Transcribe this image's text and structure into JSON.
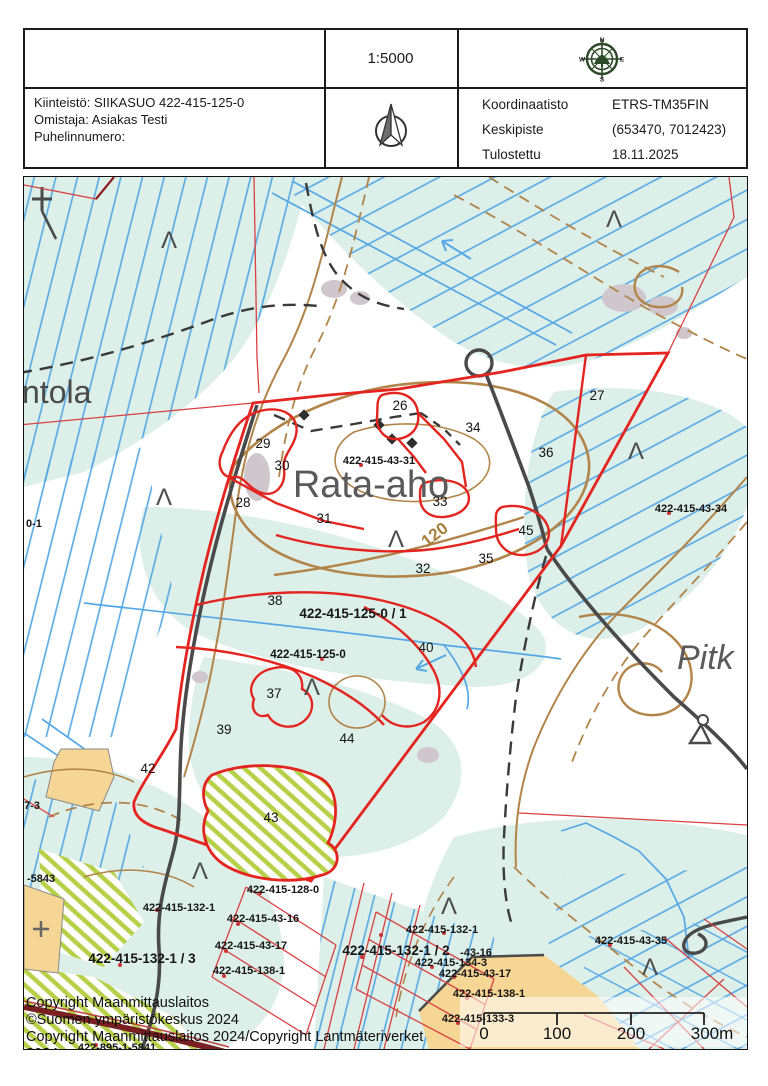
{
  "header": {
    "scale": "1:5000",
    "property": {
      "line1": "Kiinteistö: SIIKASUO 422-415-125-0",
      "line2": "Omistaja: Asiakas Testi",
      "line3": "Puhelinnumero:"
    },
    "meta": [
      {
        "key": "Koordinaatisto",
        "value": "ETRS-TM35FIN"
      },
      {
        "key": "Keskipiste",
        "value": "(653470, 7012423)"
      },
      {
        "key": "Tulostettu",
        "value": "18.11.2025"
      }
    ],
    "compass": {
      "n": "N",
      "e": "E",
      "s": "S",
      "w": "W"
    }
  },
  "map": {
    "place_names": [
      {
        "t": "ntola",
        "x": -2,
        "y": 226,
        "s": 32,
        "a": "start",
        "fill": "#4a4a4a",
        "italic": false
      },
      {
        "t": "Rata-aho",
        "x": 347,
        "y": 320,
        "s": 38,
        "a": "middle",
        "fill": "#5a5a5a",
        "italic": false
      },
      {
        "t": "Pitk",
        "x": 653,
        "y": 492,
        "s": 34,
        "a": "start",
        "fill": "#5a5a5a",
        "italic": true
      }
    ],
    "contour_label": {
      "t": "120",
      "x": 414,
      "y": 362,
      "s": 17,
      "fill": "#a5803a",
      "rot": -38
    },
    "stand_numbers": [
      {
        "t": "26",
        "x": 376,
        "y": 233
      },
      {
        "t": "27",
        "x": 573,
        "y": 223
      },
      {
        "t": "29",
        "x": 239,
        "y": 271
      },
      {
        "t": "30",
        "x": 258,
        "y": 293
      },
      {
        "t": "28",
        "x": 219,
        "y": 330
      },
      {
        "t": "31",
        "x": 300,
        "y": 346
      },
      {
        "t": "34",
        "x": 449,
        "y": 255
      },
      {
        "t": "36",
        "x": 522,
        "y": 280
      },
      {
        "t": "33",
        "x": 416,
        "y": 329
      },
      {
        "t": "45",
        "x": 502,
        "y": 358
      },
      {
        "t": "35",
        "x": 462,
        "y": 386
      },
      {
        "t": "32",
        "x": 399,
        "y": 396
      },
      {
        "t": "38",
        "x": 251,
        "y": 428
      },
      {
        "t": "40",
        "x": 402,
        "y": 475
      },
      {
        "t": "37",
        "x": 250,
        "y": 521
      },
      {
        "t": "39",
        "x": 200,
        "y": 557
      },
      {
        "t": "44",
        "x": 323,
        "y": 566
      },
      {
        "t": "42",
        "x": 124,
        "y": 596
      },
      {
        "t": "43",
        "x": 247,
        "y": 645
      }
    ],
    "parcel_ids": [
      {
        "t": "422-415-43-31",
        "x": 355,
        "y": 287,
        "s": 11
      },
      {
        "t": "422-415-43-34",
        "x": 667,
        "y": 335,
        "s": 11
      },
      {
        "t": "422-415-125-0 / 1",
        "x": 329,
        "y": 441,
        "s": 13.5
      },
      {
        "t": "422-415-125-0",
        "x": 284,
        "y": 481,
        "s": 11.5
      },
      {
        "t": "422-415-128-0",
        "x": 259,
        "y": 716,
        "s": 11
      },
      {
        "t": "422-415-132-1",
        "x": 155,
        "y": 734,
        "s": 11
      },
      {
        "t": "422-415-43-16",
        "x": 239,
        "y": 745,
        "s": 11
      },
      {
        "t": "422-415-43-17",
        "x": 227,
        "y": 772,
        "s": 11
      },
      {
        "t": "422-415-138-1",
        "x": 225,
        "y": 797,
        "s": 11
      },
      {
        "t": "422-415-132-1 / 3",
        "x": 118,
        "y": 786,
        "s": 13.5
      },
      {
        "t": "422-895-1-5841",
        "x": 93,
        "y": 874,
        "s": 11
      },
      {
        "t": "-5843",
        "x": 3,
        "y": 705,
        "s": 11,
        "a": "start"
      },
      {
        "t": "0-1",
        "x": 2,
        "y": 350,
        "s": 11,
        "a": "start"
      },
      {
        "t": "27-3",
        "x": -6,
        "y": 632,
        "s": 11,
        "a": "start"
      },
      {
        "t": "422-415-132-1",
        "x": 418,
        "y": 756,
        "s": 11
      },
      {
        "t": "422-415-132-1 / 2",
        "x": 372,
        "y": 778,
        "s": 13.5
      },
      {
        "t": "-43-16",
        "x": 452,
        "y": 779,
        "s": 11
      },
      {
        "t": "422-415-134-3",
        "x": 427,
        "y": 789,
        "s": 11
      },
      {
        "t": "422-415-43-17",
        "x": 451,
        "y": 800,
        "s": 11
      },
      {
        "t": "422-415-138-1",
        "x": 465,
        "y": 820,
        "s": 11
      },
      {
        "t": "422-415-133-3",
        "x": 454,
        "y": 845,
        "s": 11
      },
      {
        "t": "422-415-43-35",
        "x": 607,
        "y": 767,
        "s": 11
      },
      {
        "t": "422-415-43-60",
        "x": 477,
        "y": 880,
        "s": 11
      }
    ],
    "swamp": {
      "glyph": "Λ",
      "positions": [
        [
          145,
          71
        ],
        [
          590,
          50
        ],
        [
          612,
          282
        ],
        [
          372,
          370
        ],
        [
          288,
          518
        ],
        [
          176,
          702
        ],
        [
          425,
          737
        ],
        [
          626,
          798
        ],
        [
          140,
          328
        ]
      ]
    },
    "copyright_lines": [
      "Copyright Maanmittauslaitos",
      "©Suomen ympäristökeskus 2024",
      "Copyright Maanmittauslaitos 2024/Copyright Lantmäteriverket",
      "2024"
    ],
    "scale_bar": {
      "labels": [
        "0",
        "100",
        "200",
        "300m"
      ]
    }
  },
  "colors": {
    "boundary_red": "#e3241f",
    "cadastral_red": "#d94040",
    "wetland_cyan": "#dcefe9",
    "ditch_blue": "#55a8e5",
    "contour_brown": "#b28449",
    "road_gray": "#4a4a4a",
    "field_orange": "#f6d694",
    "hatch_green": "#b6d048",
    "maroon_road": "#7a1f22"
  }
}
